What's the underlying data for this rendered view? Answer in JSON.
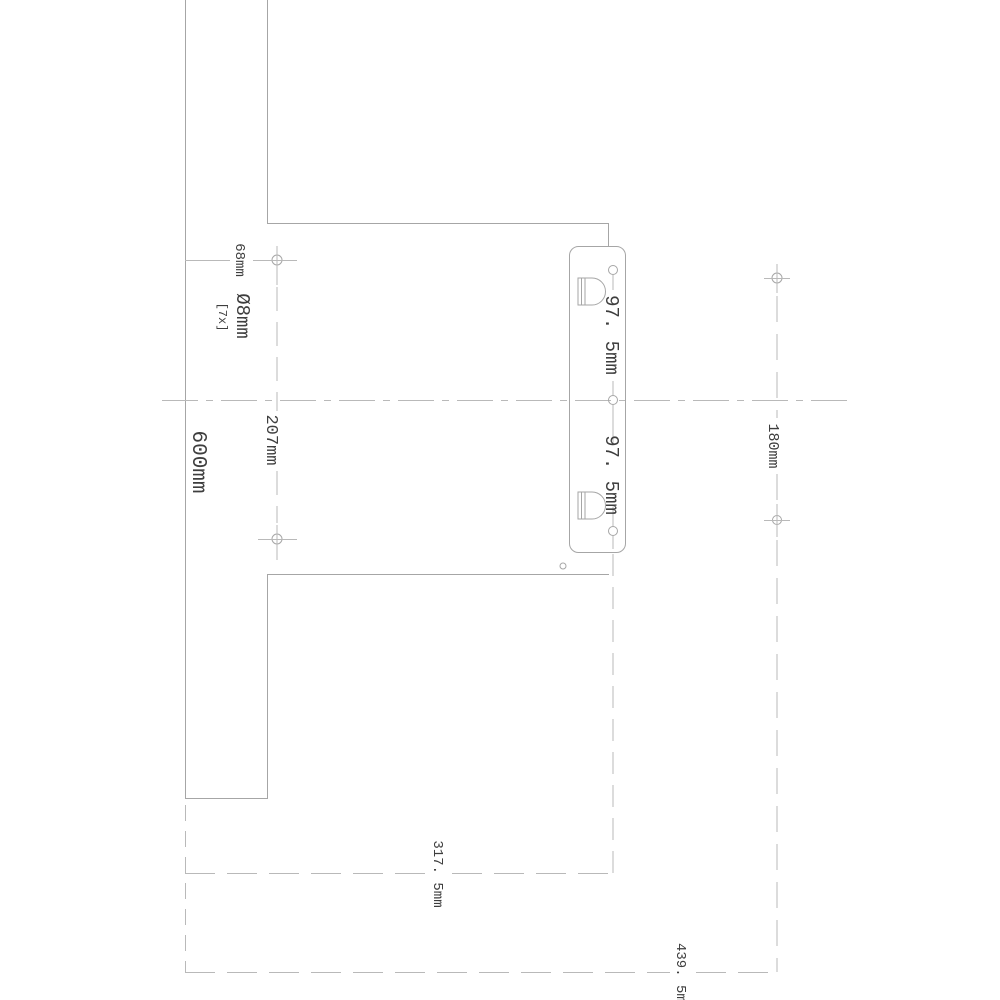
{
  "colors": {
    "line": "#a6a6a6",
    "dim": "#b9b9b9",
    "text": "#3e3e3e",
    "background": "#ffffff"
  },
  "labels": {
    "edge_to_hole_offset": "68mm",
    "hole_diameter": "Ø8mm",
    "hole_count": "[7x]",
    "panel_height": "600mm",
    "hole_spacing_vertical": "207mm",
    "bracket_pitch_upper": "97. 5mm",
    "bracket_pitch_lower": "97. 5mm",
    "right_hole_spacing": "180mm",
    "bracket_center_offset": "317. 5mm",
    "right_holes_offset": "439. 5mm"
  }
}
